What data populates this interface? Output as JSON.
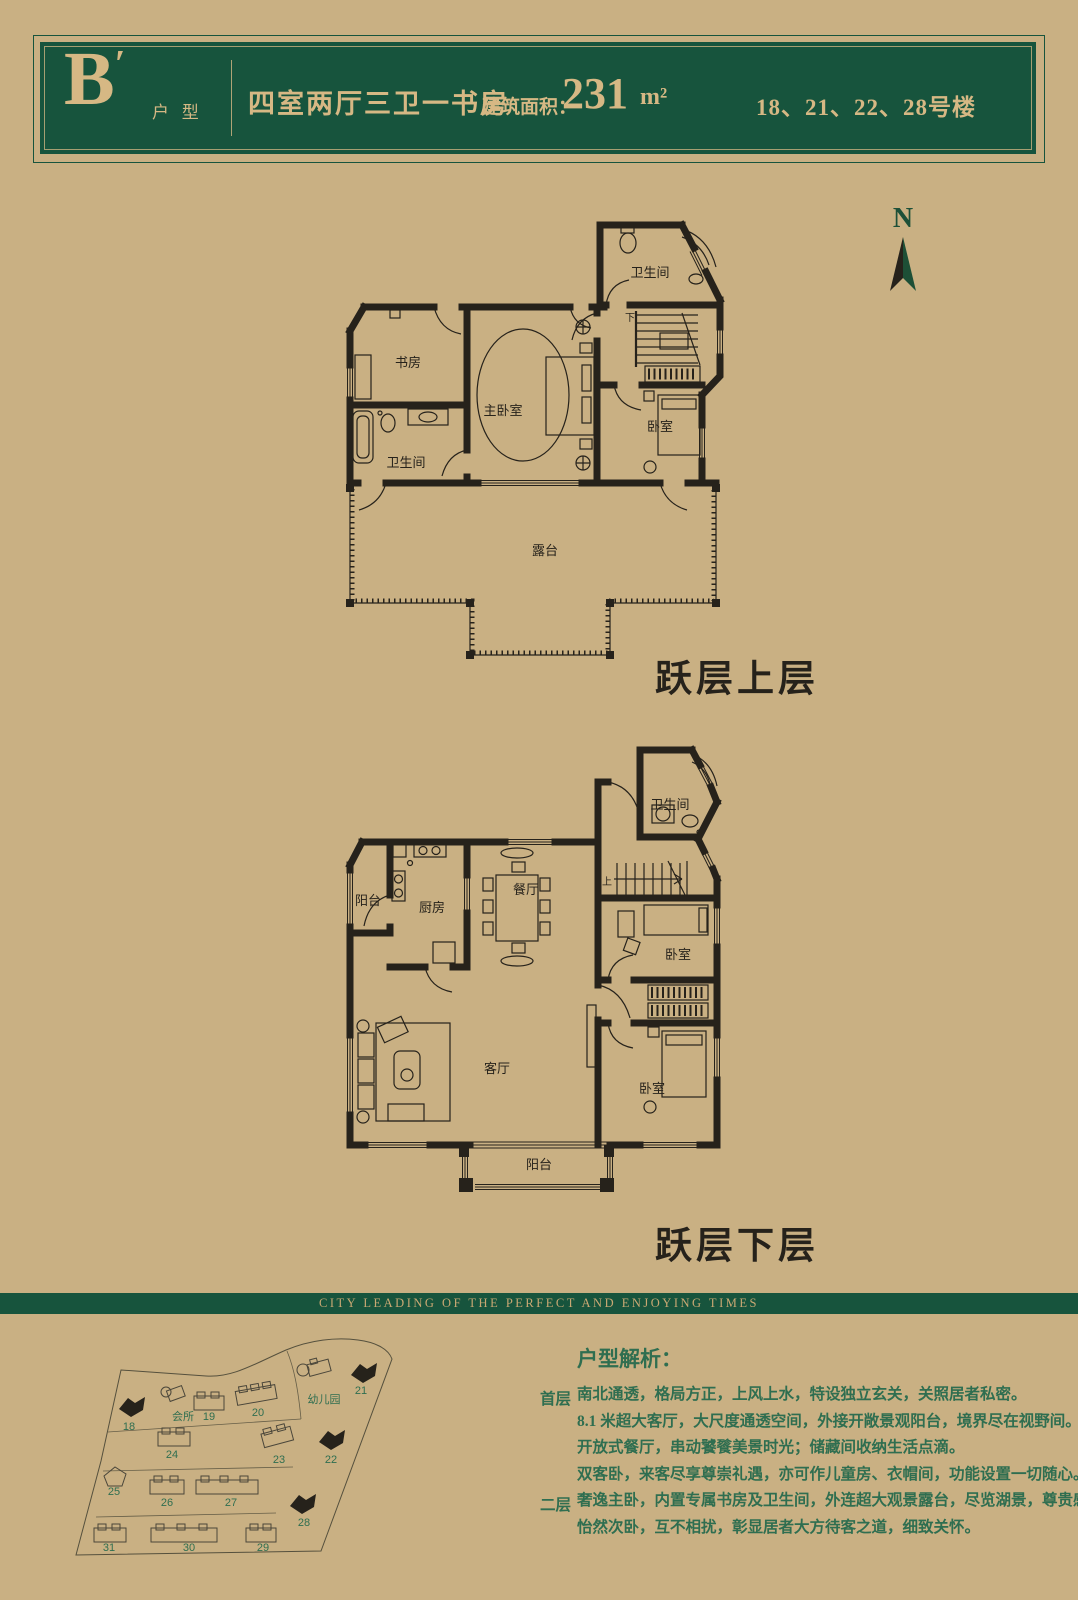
{
  "colors": {
    "background": "#c9b083",
    "brand_green": "#17543d",
    "gold": "#d6b884",
    "ink": "#26221b",
    "text_green": "#2f6e50"
  },
  "header": {
    "unit_letter": "B",
    "unit_prime": "′",
    "unit_suffix": "户 型",
    "layout": "四室两厅三卫一书房",
    "area_label": "建筑面积：",
    "area_value": "231",
    "area_unit": "m²",
    "buildings": "18、21、22、28号楼"
  },
  "compass": {
    "label": "N"
  },
  "plans": {
    "upper": {
      "title": "跃层上层",
      "rooms": {
        "bath_top": "卫生间",
        "study": "书房",
        "master": "主卧室",
        "bedroom": "卧室",
        "bath_low": "卫生间",
        "terrace": "露台",
        "stairs_down": "下"
      }
    },
    "lower": {
      "title": "跃层下层",
      "rooms": {
        "bath": "卫生间",
        "balcony_w": "阳台",
        "kitchen": "厨房",
        "dining": "餐厅",
        "bedroom_n": "卧室",
        "living": "客厅",
        "bedroom_s": "卧室",
        "balcony_s": "阳台",
        "stairs_up": "上"
      }
    }
  },
  "banner": {
    "slogan": "CITY LEADING OF THE PERFECT AND ENJOYING TIMES"
  },
  "sitemap": {
    "buildings": [
      {
        "label": "18",
        "filled": true
      },
      {
        "label": "19",
        "filled": false
      },
      {
        "label": "20",
        "filled": false
      },
      {
        "label": "21",
        "filled": true
      },
      {
        "label": "22",
        "filled": true
      },
      {
        "label": "23",
        "filled": false
      },
      {
        "label": "24",
        "filled": false
      },
      {
        "label": "25",
        "filled": false
      },
      {
        "label": "26",
        "filled": false
      },
      {
        "label": "27",
        "filled": false
      },
      {
        "label": "28",
        "filled": true
      },
      {
        "label": "29",
        "filled": false
      },
      {
        "label": "30",
        "filled": false
      },
      {
        "label": "31",
        "filled": false
      },
      {
        "label": "会所",
        "filled": false
      },
      {
        "label": "幼儿园",
        "filled": false
      }
    ]
  },
  "analysis": {
    "heading": "户型解析：",
    "sections": [
      {
        "label": "首层",
        "lines": [
          "南北通透，格局方正，上风上水，特设独立玄关，关照居者私密。",
          "8.1 米超大客厅，大尺度通透空间，外接开敞景观阳台，境界尽在视野间。",
          "开放式餐厅，串动饕餮美景时光；储藏间收纳生活点滴。",
          "双客卧，来客尽享尊崇礼遇，亦可作儿童房、衣帽间，功能设置一切随心。"
        ]
      },
      {
        "label": "二层",
        "lines": [
          "奢逸主卧，内置专属书房及卫生间，外连超大观景露台，尽览湖景，尊贵感浸润其中",
          "怡然次卧，互不相扰，彰显居者大方待客之道，细致关怀。"
        ]
      }
    ]
  }
}
